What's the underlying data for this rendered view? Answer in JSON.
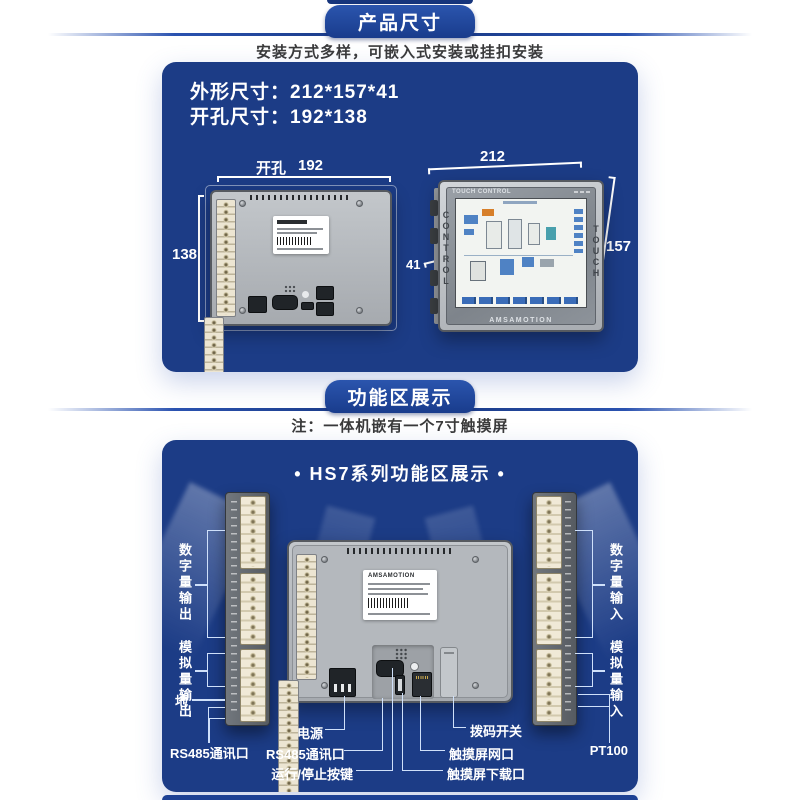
{
  "section1": {
    "ribbon": "产品尺寸",
    "subtitle": "安装方式多样，可嵌入式安装或挂扣安装",
    "dims": {
      "line1": "外形尺寸：212*157*41",
      "line2": "开孔尺寸：192*138"
    },
    "back_view": {
      "cutout_label": "开孔",
      "cutout_width": "192",
      "cutout_height": "138"
    },
    "front_view": {
      "width": "212",
      "height": "157",
      "depth": "41",
      "screen_header": "TOUCH CONTROL",
      "bezel_left": "CONTROL",
      "bezel_right": "TOUCH",
      "brand": "AMSAMOTION"
    }
  },
  "section2": {
    "ribbon": "功能区展示",
    "note": "注：一体机嵌有一个7寸触摸屏",
    "panel_title": "• HS7系列功能区展示 •",
    "device_brand": "AMSAMOTION",
    "left_labels": {
      "digital_out": "数字量输出",
      "analog_out": "模拟量输出",
      "ground": "地",
      "rs485": "RS485通讯口"
    },
    "right_labels": {
      "digital_in": "数字量输入",
      "analog_in": "模拟量输入",
      "pt100": "PT100"
    },
    "bottom_labels": {
      "power": "电源",
      "rs485": "RS485通讯口",
      "run_stop": "运行/停止按键",
      "dip": "拨码开关",
      "hmi_eth": "触摸屏网口",
      "hmi_dl": "触摸屏下载口"
    }
  },
  "colors": {
    "panel": "#1c3c86",
    "ribbon": "#1d4194",
    "accent_line": "#2a52b0"
  }
}
